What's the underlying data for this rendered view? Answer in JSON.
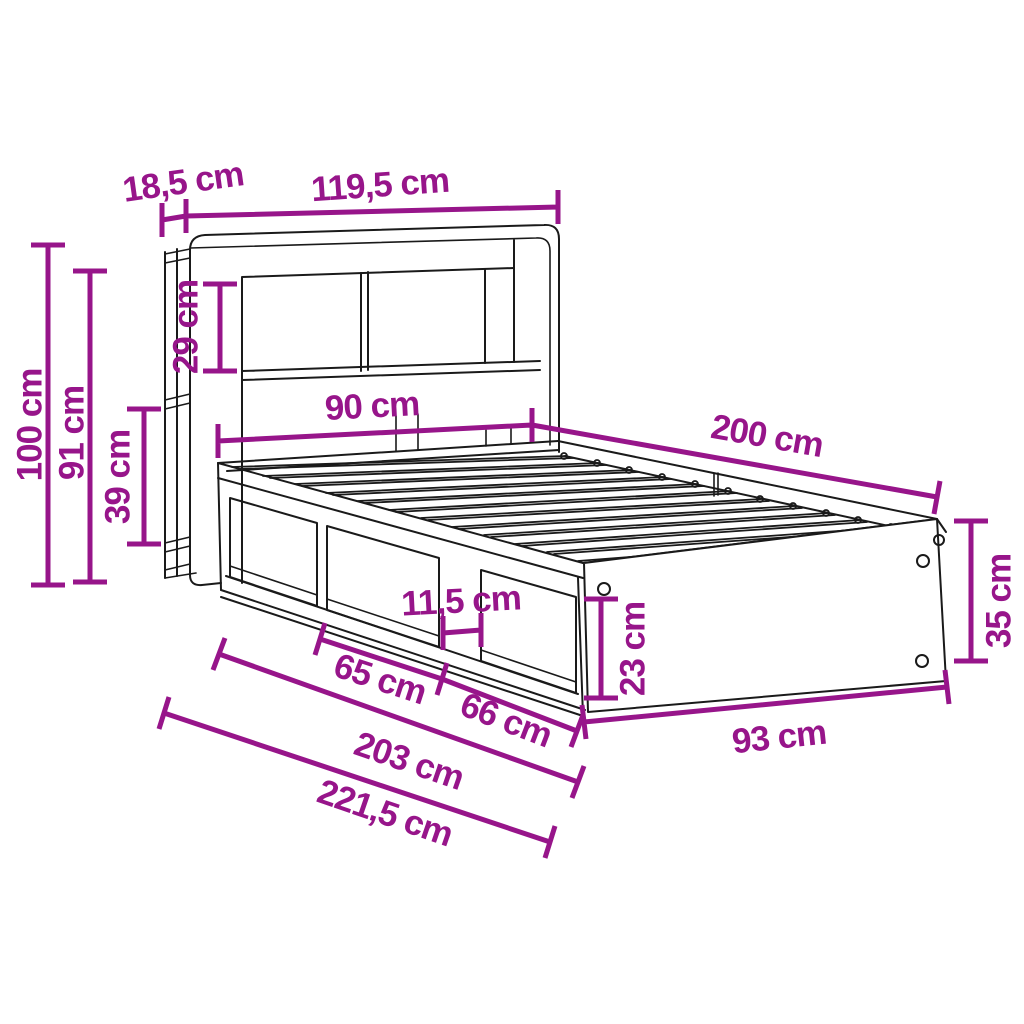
{
  "diagram": {
    "unit": "cm",
    "colors": {
      "dimension_accent": "#97158A",
      "line_art": "#1A1A1A",
      "background": "#FFFFFF"
    },
    "dims": {
      "headboard_depth": {
        "label": "18,5 cm",
        "value": 18.5
      },
      "headboard_width": {
        "label": "119,5 cm",
        "value": 119.5
      },
      "headboard_opening_height": {
        "label": "29 cm",
        "value": 29
      },
      "total_height": {
        "label": "100 cm",
        "value": 100
      },
      "headboard_height": {
        "label": "91 cm",
        "value": 91
      },
      "side_shelf_opening_height": {
        "label": "39 cm",
        "value": 39
      },
      "bed_width": {
        "label": "90 cm",
        "value": 90
      },
      "bed_length": {
        "label": "200 cm",
        "value": 200
      },
      "pillar_width": {
        "label": "11,5 cm",
        "value": 11.5
      },
      "storage_opening_height": {
        "label": "23 cm",
        "value": 23
      },
      "frame_height": {
        "label": "35 cm",
        "value": 35
      },
      "storage_left_width": {
        "label": "65 cm",
        "value": 65
      },
      "storage_right_width": {
        "label": "66 cm",
        "value": 66
      },
      "foot_width": {
        "label": "93 cm",
        "value": 93
      },
      "frame_length": {
        "label": "203 cm",
        "value": 203
      },
      "total_length": {
        "label": "221,5 cm",
        "value": 221.5
      }
    }
  }
}
